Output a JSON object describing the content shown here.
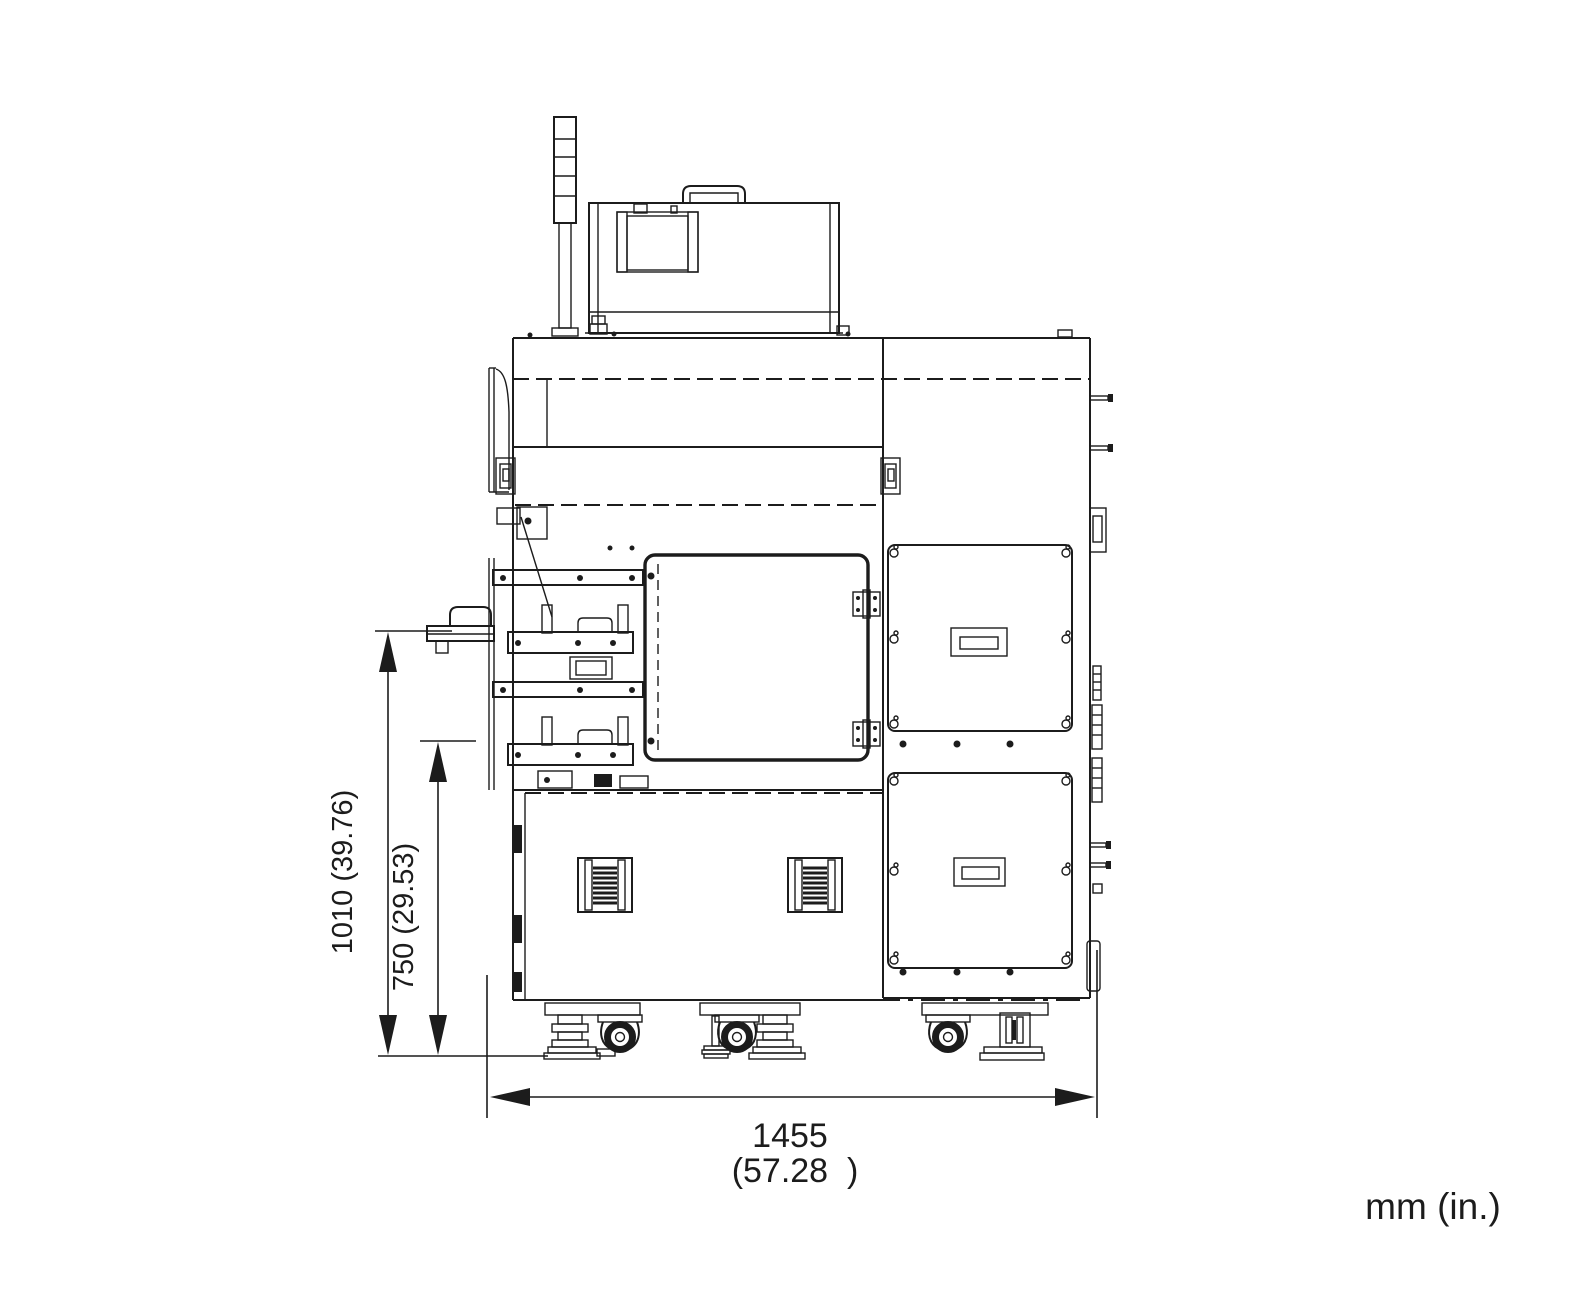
{
  "page": {
    "background": "#ffffff",
    "line_color": "#1c1c1c"
  },
  "drawing": {
    "view": "machine-front-elevation-dimension-diagram",
    "units_label": "mm (in.)",
    "dimensions": {
      "overall_height": {
        "label": "1010 (39.76)",
        "mm": "1010",
        "inches": "39.76",
        "orientation": "vertical"
      },
      "tray_height": {
        "label": "750 (29.53)",
        "mm": "750",
        "inches": "29.53",
        "orientation": "vertical"
      },
      "overall_width": {
        "mm_label": "1455",
        "inches_label": "(57.28  )",
        "mm": "1455",
        "inches": "57.28",
        "orientation": "horizontal"
      }
    },
    "components": [
      "signal-tower",
      "display-unit",
      "carrying-handle",
      "tray-upper",
      "tray-lower",
      "front-door",
      "door-hinges",
      "access-panel-upper",
      "access-panel-lower",
      "vent-grille-left",
      "vent-grille-right",
      "casters",
      "leveling-feet"
    ]
  }
}
